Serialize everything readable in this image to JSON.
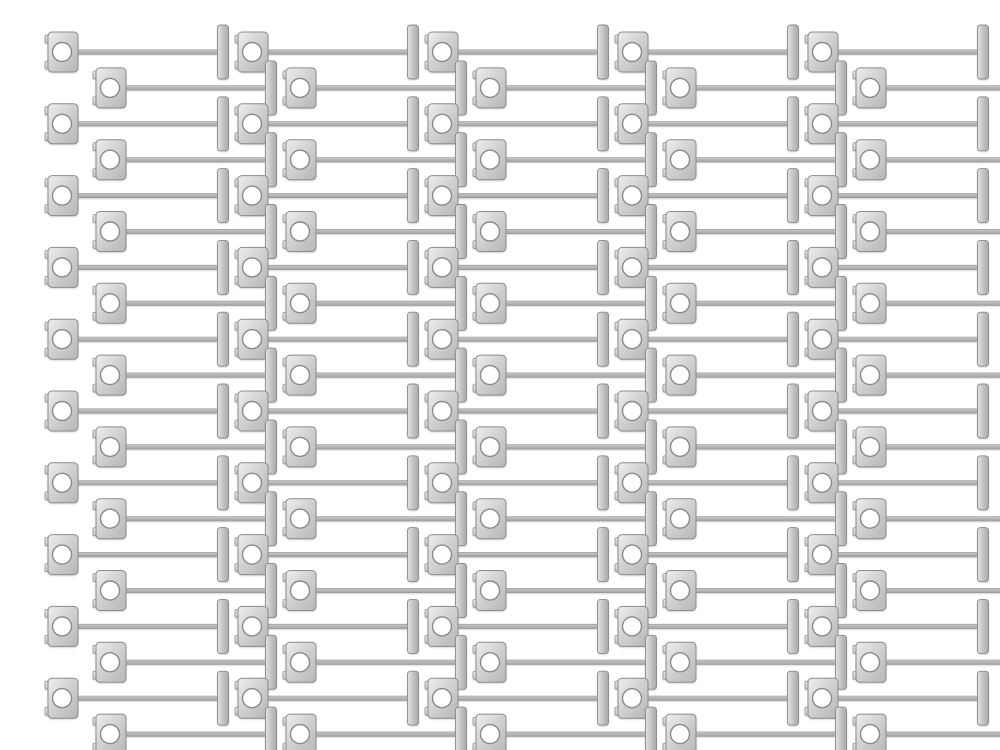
{
  "scene": {
    "type": "product-photo",
    "description": "Dozens of identical silver metal T-pin fasteners, each with a square washer plate that has a round eyelet hole, a long thin shaft, and a T-shaped crossbar tip, arranged in tightly interleaved horizontal rows on a plain white background",
    "object_name": "metal T-pin fastener with square eyelet plate",
    "item_count": 100,
    "background_color": "#ffffff"
  },
  "pattern": {
    "rows": 20,
    "units_per_row": 5,
    "row_pitch_y": 35.9,
    "first_row_center_y": 36,
    "unit_pitch_x": 190,
    "even_row_start_x": 5,
    "odd_row_start_x": 53,
    "canvas_width": 1000,
    "canvas_height": 750
  },
  "part": {
    "plate_total_width": 33,
    "plate_body_inset_x": 3,
    "plate_body_width": 30,
    "plate_height": 40,
    "plate_corner_radius": 4,
    "tab_width": 7.5,
    "tab_height": 8,
    "tab_gap_from_center": 9,
    "tab_corner_radius": 1.5,
    "hole_center_offset_x": 17,
    "hole_radius": 9.5,
    "rod_start_offset_x": 31,
    "rod_length": 147,
    "rod_thickness": 4.4,
    "tbar_center_offset_x": 178,
    "tbar_width": 11,
    "tbar_height": 54,
    "tbar_corner_radius": 3
  },
  "colors": {
    "background": "#ffffff",
    "metal_highlight": "#ededed",
    "metal_light": "#dcdcdc",
    "metal_mid": "#c4c4c4",
    "metal_shade": "#b2b2b2",
    "edge": "#8c8c8c",
    "hole_fill": "#ffffff"
  }
}
